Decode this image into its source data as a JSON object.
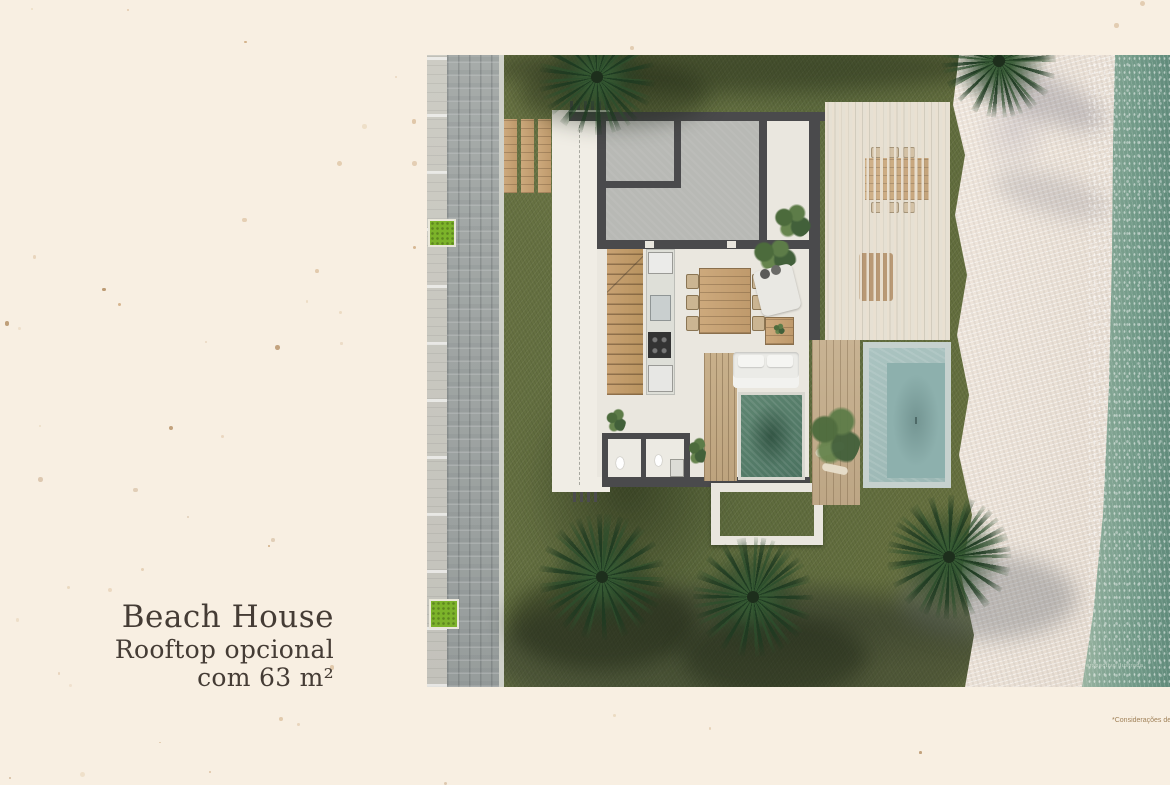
{
  "page": {
    "background_color": "#f8efe2"
  },
  "caption": {
    "title": "Beach House",
    "subtitle1": "Rooftop opcional",
    "subtitle2": "com 63 m²",
    "text_color": "#453c35"
  },
  "footnote": {
    "text": "*Considerações de"
  },
  "watermark": {
    "text": "Perspectiva ilustrada"
  },
  "palette": {
    "background_cream": "#f8efe2",
    "grass_green": "#67713f",
    "road_gray": "#9aa09f",
    "sidewalk_gray": "#c7c6bf",
    "planter_green": "#7cb32a",
    "wall_dark": "#4a4a4c",
    "roof_slab_gray": "#b8b9b5",
    "floor_white": "#eae7df",
    "wood_tan": "#c29e73",
    "deck_wood": "#c3ab87",
    "pergola_slat": "#e7decf",
    "plunge_pool_green": "#59806d",
    "lap_pool_blue": "#a2bfbc",
    "sand_beige": "#ece2d7",
    "sea_teal": "#6f9a8b",
    "speckle_colors": [
      "#d9bb97",
      "#c1935f",
      "#e6d2b4",
      "#a97f4f"
    ]
  }
}
